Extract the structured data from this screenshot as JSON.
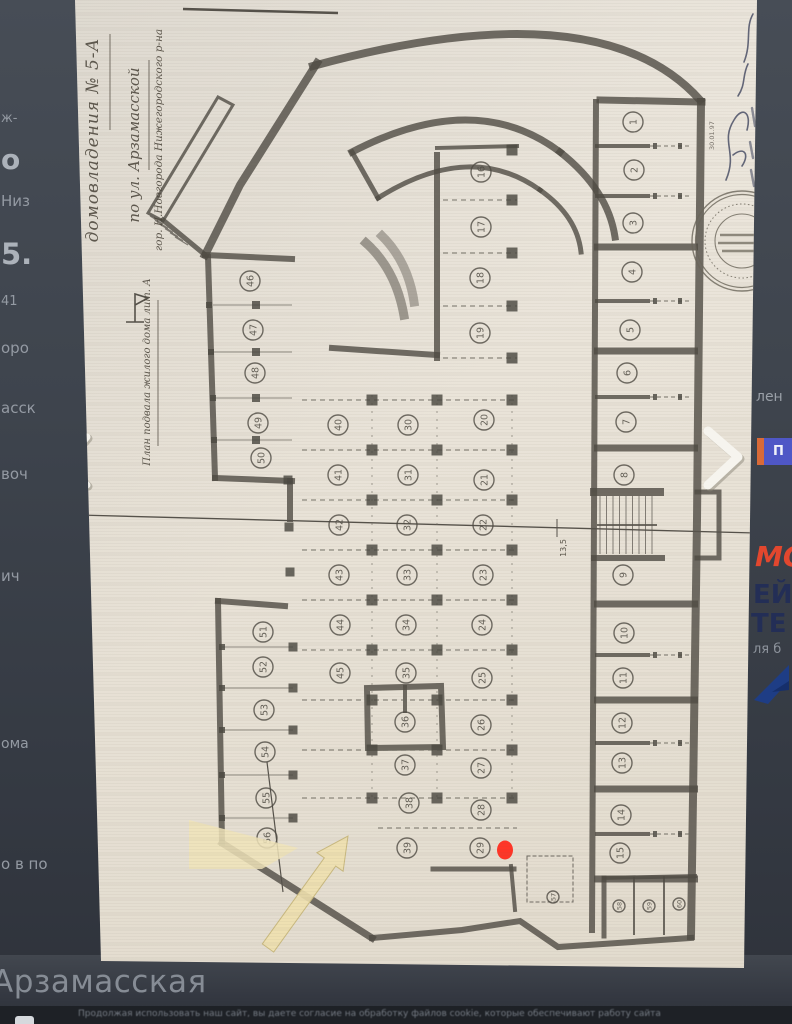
{
  "page": {
    "street_caption": "Арзамасская",
    "cookie_text": "Продолжая использовать наш сайт, вы даете согласие на обработку файлов cookie, которые обеспечивают работу сайта"
  },
  "left_rail": {
    "fragments": [
      {
        "text": "ж-",
        "y": 112,
        "s": 13,
        "b": 0
      },
      {
        "text": "о",
        "y": 146,
        "s": 28,
        "b": 1
      },
      {
        "text": "Низ",
        "y": 194,
        "s": 15,
        "b": 0
      },
      {
        "text": "5.",
        "y": 240,
        "s": 29,
        "b": 1
      },
      {
        "text": "41",
        "y": 295,
        "s": 13,
        "b": 0
      },
      {
        "text": "оро",
        "y": 341,
        "s": 15,
        "b": 0
      },
      {
        "text": "асск",
        "y": 401,
        "s": 15,
        "b": 0
      },
      {
        "text": "воч",
        "y": 467,
        "s": 15,
        "b": 0
      },
      {
        "text": "ич",
        "y": 569,
        "s": 15,
        "b": 0
      },
      {
        "text": "ома",
        "y": 737,
        "s": 14,
        "b": 0
      },
      {
        "text": "о в по",
        "y": 857,
        "s": 15,
        "b": 0
      }
    ]
  },
  "right_rail": {
    "fragment_top": "лен",
    "button_label": "П",
    "ad_word_1": "МО",
    "ad_word_2": "ЕЙ",
    "ad_word_3": "ТЕ",
    "ad_sub": "ля б",
    "ad_red": "#e2472e",
    "ad_navy": "#232e56"
  },
  "plan": {
    "title_line_1": "домовладения № 5-А",
    "title_line_2": "по ул. Арзамасской",
    "title_line_3": "гор. Н.Новгорода Нижегородского р-на",
    "subtitle": "План подвала жилого дома лит. А",
    "dimension_label": "13,5",
    "stamp_date": "30.01.97",
    "marker_color": "#ff3527",
    "stalls": [
      [
        1,
        633,
        122
      ],
      [
        2,
        634,
        170
      ],
      [
        3,
        633,
        223
      ],
      [
        4,
        632,
        272
      ],
      [
        5,
        630,
        330
      ],
      [
        6,
        627,
        373
      ],
      [
        7,
        626,
        422
      ],
      [
        8,
        624,
        475
      ],
      [
        9,
        623,
        575
      ],
      [
        10,
        624,
        633
      ],
      [
        11,
        623,
        678
      ],
      [
        12,
        622,
        723
      ],
      [
        13,
        622,
        763
      ],
      [
        14,
        621,
        815
      ],
      [
        15,
        620,
        853
      ],
      [
        16,
        481,
        172
      ],
      [
        17,
        481,
        227
      ],
      [
        18,
        480,
        278
      ],
      [
        19,
        480,
        333
      ],
      [
        20,
        484,
        420
      ],
      [
        21,
        484,
        480
      ],
      [
        22,
        483,
        525
      ],
      [
        23,
        483,
        575
      ],
      [
        24,
        482,
        625
      ],
      [
        25,
        482,
        678
      ],
      [
        26,
        481,
        725
      ],
      [
        27,
        481,
        768
      ],
      [
        28,
        481,
        810
      ],
      [
        29,
        480,
        848
      ],
      [
        30,
        408,
        425
      ],
      [
        31,
        408,
        475
      ],
      [
        32,
        407,
        525
      ],
      [
        33,
        407,
        575
      ],
      [
        34,
        406,
        625
      ],
      [
        35,
        406,
        673
      ],
      [
        36,
        405,
        722
      ],
      [
        37,
        405,
        765
      ],
      [
        38,
        409,
        803
      ],
      [
        39,
        407,
        848
      ],
      [
        40,
        338,
        425
      ],
      [
        41,
        338,
        475
      ],
      [
        42,
        339,
        525
      ],
      [
        43,
        339,
        575
      ],
      [
        44,
        340,
        625
      ],
      [
        45,
        340,
        673
      ],
      [
        46,
        250,
        281
      ],
      [
        47,
        253,
        330
      ],
      [
        48,
        255,
        373
      ],
      [
        49,
        258,
        423
      ],
      [
        50,
        261,
        458
      ],
      [
        51,
        263,
        632
      ],
      [
        52,
        263,
        667
      ],
      [
        53,
        264,
        710
      ],
      [
        54,
        265,
        752
      ],
      [
        55,
        266,
        798
      ],
      [
        56,
        267,
        838
      ],
      [
        57,
        553,
        897,
        6
      ],
      [
        58,
        619,
        906,
        6
      ],
      [
        59,
        649,
        906,
        6
      ],
      [
        60,
        679,
        904,
        6
      ]
    ]
  }
}
